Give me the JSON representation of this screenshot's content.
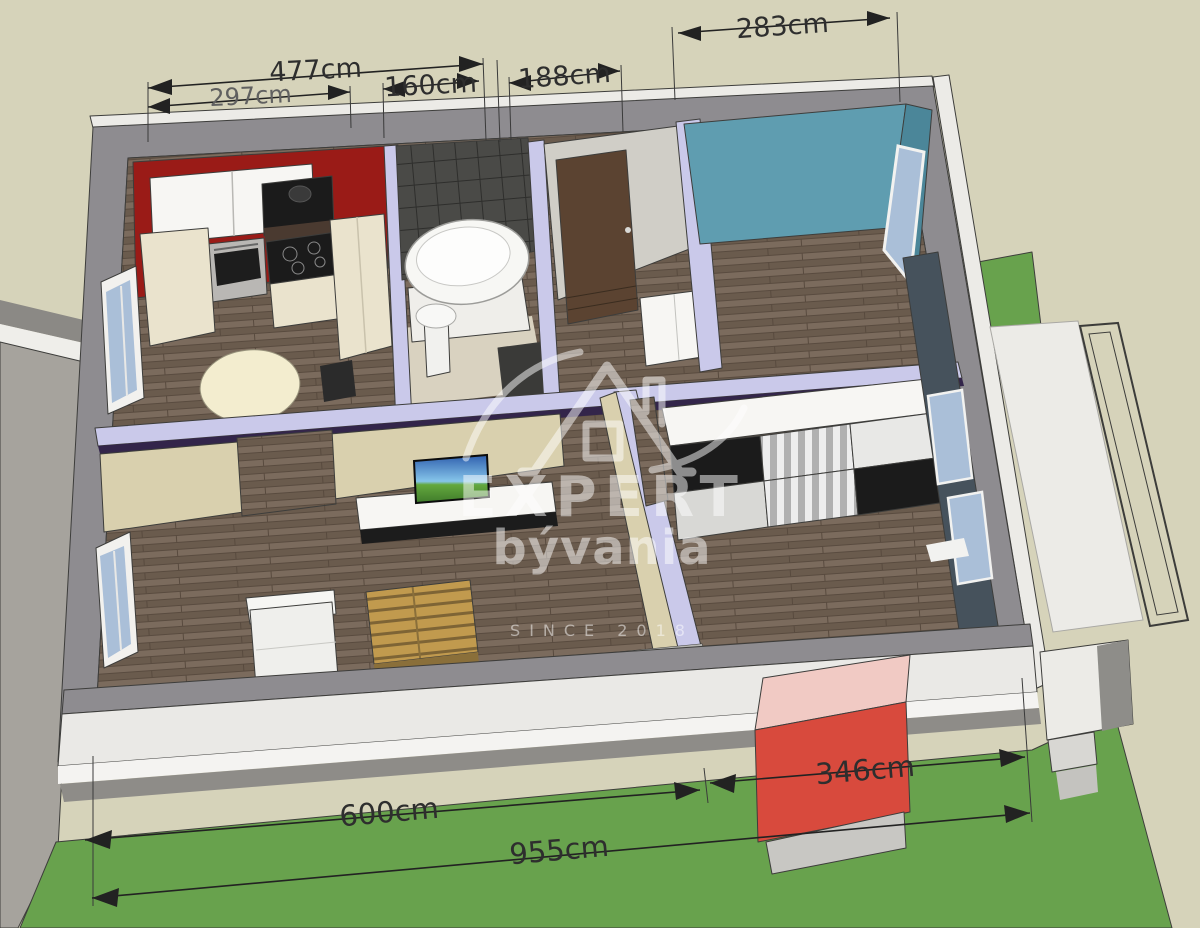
{
  "scene": {
    "watermark": {
      "brand": "EXPERT",
      "name": "bývania",
      "since": "SINCE 2018"
    },
    "dimensions": [
      {
        "id": "477",
        "label": "477cm"
      },
      {
        "id": "297",
        "label": "297cm"
      },
      {
        "id": "160",
        "label": "160cm"
      },
      {
        "id": "188",
        "label": "188cm"
      },
      {
        "id": "283",
        "label": "283cm"
      },
      {
        "id": "600",
        "label": "600cm"
      },
      {
        "id": "346",
        "label": "346cm"
      },
      {
        "id": "955",
        "label": "955cm"
      }
    ],
    "palette": {
      "bg_beige": "#d6d3ba",
      "grass": "#68a24d",
      "concrete": "#a6a39d",
      "wall_gray": "#8e8c90",
      "wall_light": "#ecebe7",
      "wall_top_lavender": "#cac9ea",
      "wall_edge_purple": "#33254a",
      "floor_wood": "#7b6b5d",
      "floor_wood_dark": "#6a5b4d",
      "kitchen_red": "#9a1b17",
      "tile_dark": "#4a4a47",
      "bath_floor": "#d9d2c0",
      "hall_wall": "#d0cec7",
      "door_brown": "#5b4331",
      "bedroom_blue": "#5f9db0",
      "bedroom_blue_dark": "#4b8699",
      "bedroom2_wall": "#46525c",
      "window_glass": "#aabfd8",
      "living_beige": "#d9d0ae",
      "cabinet_cream": "#eae3cd",
      "cabinet_white": "#f7f6f3",
      "appliance_black": "#1b1b1b",
      "table_cream": "#f3edcf",
      "pallet_wood": "#c19a4e",
      "pallet_dark": "#8a6f3a",
      "chair_white": "#efefec",
      "sofa_gray": "#c7c7c3",
      "chimney_red": "#d84a3d",
      "chimney_pink": "#f1cac4",
      "dim_line": "#222222",
      "dim_text": "#2e2e2e",
      "dim_text_gray": "#606060",
      "watermark": "#ffffff"
    }
  }
}
